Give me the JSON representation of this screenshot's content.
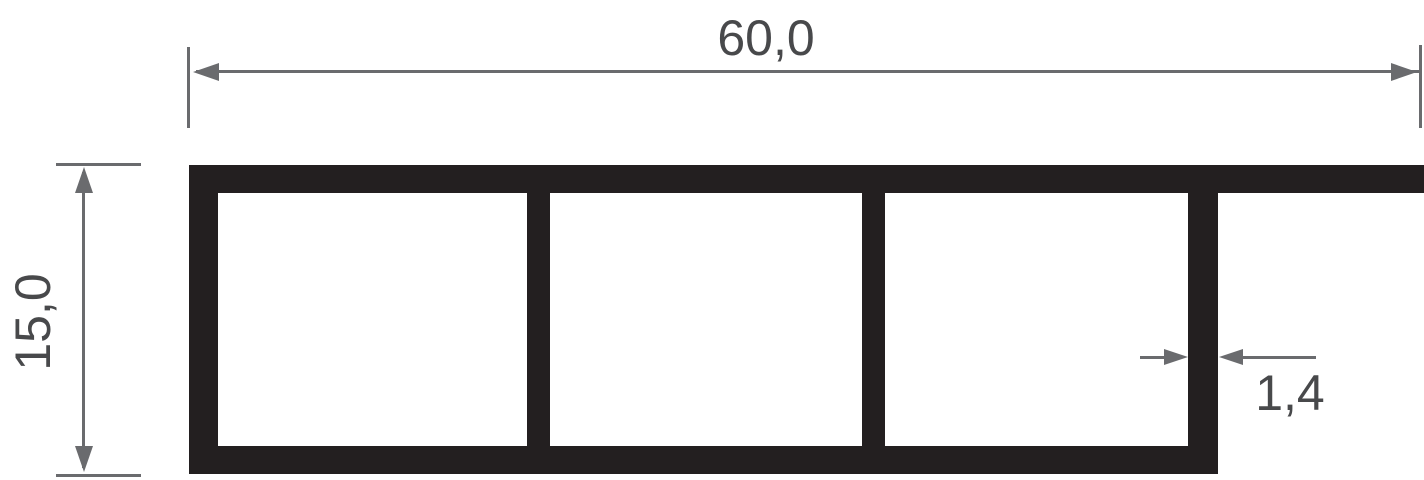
{
  "drawing": {
    "type": "technical cross-section of multi-chamber hollow profile",
    "labels": {
      "width": "60,0",
      "height": "15,0",
      "wall_thickness": "1,4"
    },
    "colors": {
      "profile_fill": "#231f20",
      "dimension_lines": "#6a6b6e",
      "dimension_text": "#48494b",
      "background": "#ffffff"
    }
  }
}
